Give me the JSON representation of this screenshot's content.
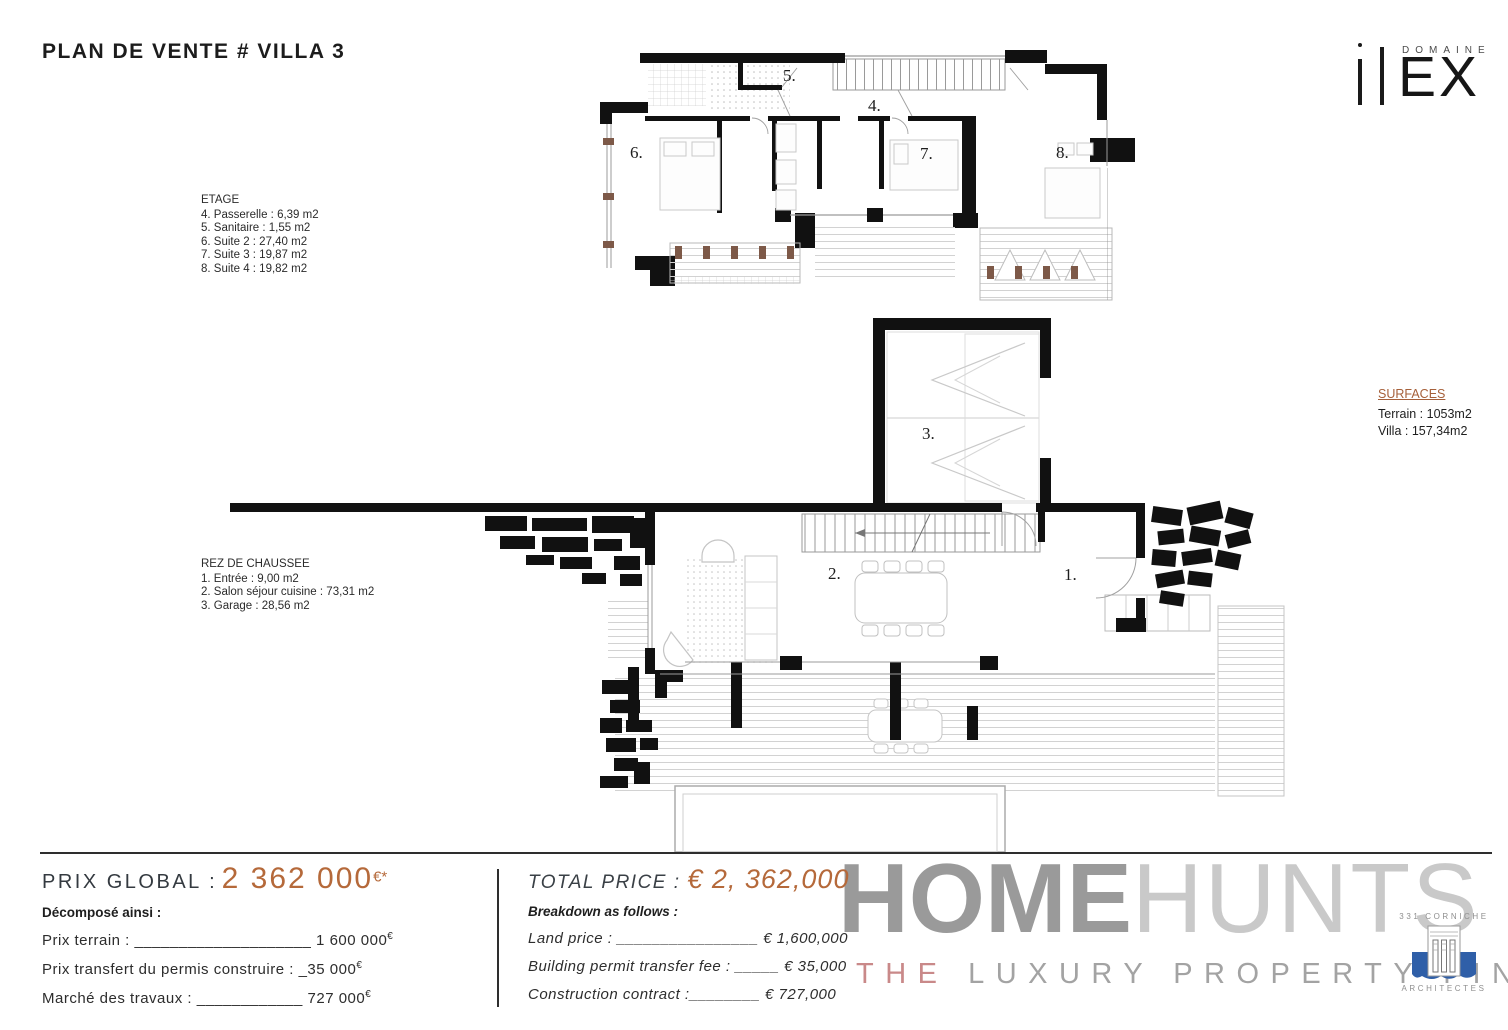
{
  "title": "PLAN DE VENTE # VILLA 3",
  "brand": {
    "domaine": "DOMAINE",
    "ex": "EX"
  },
  "etage": {
    "heading": "ETAGE",
    "lines": [
      "4. Passerelle : 6,39 m2",
      "5. Sanitaire : 1,55 m2",
      "6. Suite 2 : 27,40 m2",
      "7. Suite 3 : 19,87 m2",
      "8. Suite 4 : 19,82 m2"
    ],
    "labels": [
      "4.",
      "5.",
      "6.",
      "7.",
      "8."
    ]
  },
  "rdc": {
    "heading": "REZ DE CHAUSSEE",
    "lines": [
      "1. Entrée : 9,00 m2",
      "2. Salon séjour cuisine : 73,31 m2",
      "3. Garage : 28,56 m2"
    ],
    "labels": [
      "1.",
      "2.",
      "3."
    ]
  },
  "surfaces": {
    "heading": "SURFACES",
    "terrain": "Terrain : 1053m2",
    "villa": "Villa : 157,34m2"
  },
  "pricing_fr": {
    "label": "PRIX GLOBAL :",
    "amount": "2 362 000",
    "currency": "€*",
    "sub": "Décomposé ainsi :",
    "rows": [
      {
        "label": "Prix terrain : ",
        "fill": "____________________",
        "value": " 1 600 000",
        "cur": "€"
      },
      {
        "label": "Prix transfert du permis construire : ",
        "fill": "_",
        "value": "35 000",
        "cur": "€"
      },
      {
        "label": "Marché des travaux : ",
        "fill": "____________",
        "value": " 727 000",
        "cur": "€"
      }
    ]
  },
  "pricing_en": {
    "label": "TOTAL PRICE : ",
    "amount": "€ 2, 362,000",
    "sub": "Breakdown as follows :",
    "rows": [
      {
        "label": "Land price : ",
        "fill": "________________",
        "value": " € 1,600,000"
      },
      {
        "label": "Building permit transfer fee : ",
        "fill": "_____",
        "value": " € 35,000"
      },
      {
        "label": "Construction contract :",
        "fill": "________",
        "value": " € 727,000"
      }
    ]
  },
  "watermark": {
    "home": "HOME",
    "hunts": "HUNTS",
    "the": "THE ",
    "rest": "LUXURY PROPERTY FINDERS"
  },
  "architect": {
    "top": "331 CORNICHE",
    "bottom": "ARCHITECTES"
  },
  "colors": {
    "accent_orange": "#b5693a",
    "surfaces_orange": "#a6603a",
    "watermark_dark": "#9a9a9a",
    "watermark_light": "#c9c9c9",
    "watermark_red": "#c98989",
    "architect_blue": "#2f5fa8"
  }
}
